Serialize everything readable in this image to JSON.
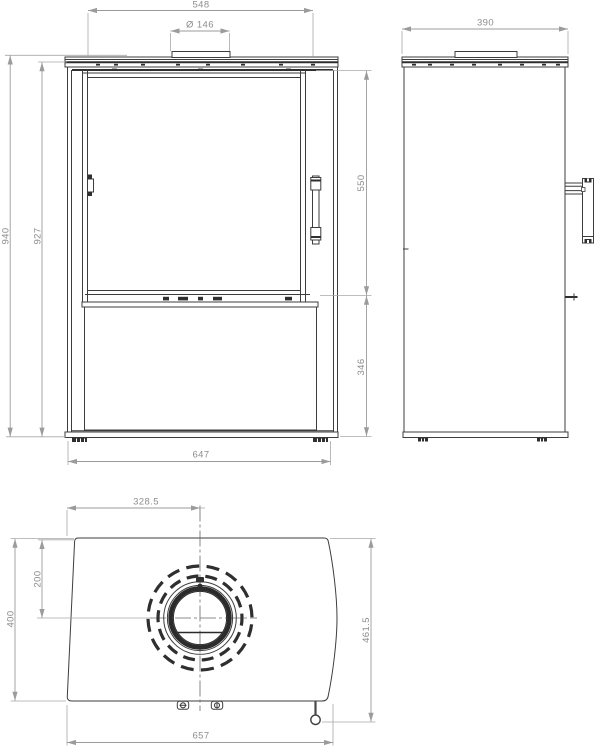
{
  "dimensions": {
    "front": {
      "top_width": "548",
      "flue_diameter": "Ø 146",
      "overall_height": "940",
      "body_height": "927",
      "door_section_height": "550",
      "base_section_height": "346",
      "base_width": "647"
    },
    "side": {
      "depth": "390"
    },
    "top": {
      "flue_center_from_left": "328.5",
      "flue_center_from_back": "200",
      "body_depth": "400",
      "overall_depth_with_handle": "461.5",
      "overall_width": "657"
    }
  },
  "colors": {
    "background": "#ffffff",
    "outline": "#3d3d3d",
    "dimension_line": "#9b9b9b",
    "dimension_text": "#8d8d8d"
  }
}
